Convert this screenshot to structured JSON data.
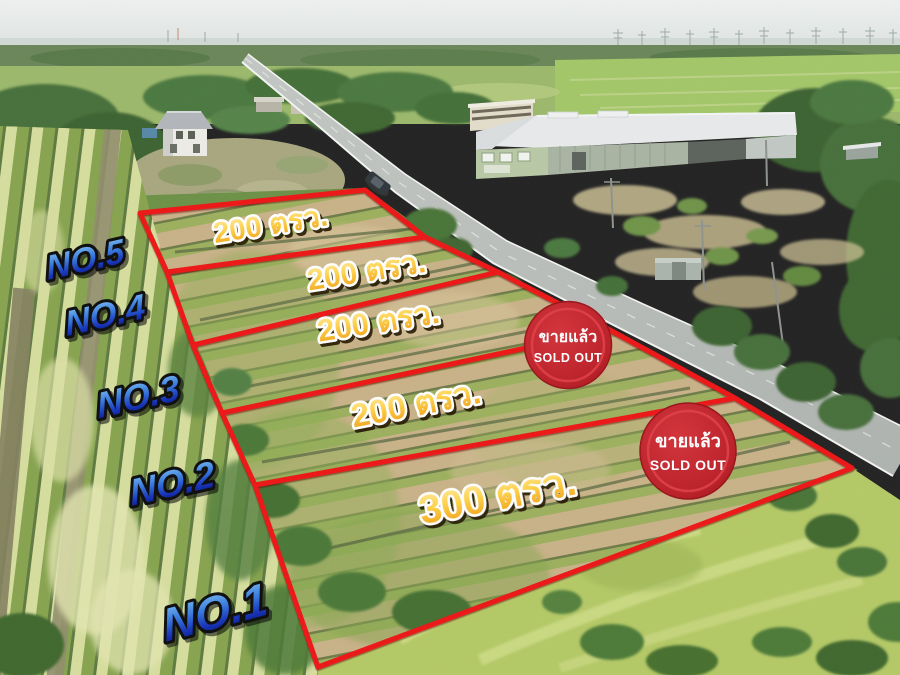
{
  "ad": {
    "kind": "aerial-land-subdivision-sale-photo"
  },
  "plots": [
    {
      "number": "NO.5",
      "size": "200 ตรว."
    },
    {
      "number": "NO.4",
      "size": "200 ตรว."
    },
    {
      "number": "NO.3",
      "size": "200 ตรว."
    },
    {
      "number": "NO.2",
      "size": "200 ตรว."
    },
    {
      "number": "NO.1",
      "size": "300 ตรว."
    }
  ],
  "badges": [
    {
      "thai": "ขายแล้ว",
      "english": "SOLD OUT"
    },
    {
      "thai": "ขายแล้ว",
      "english": "SOLD OUT"
    }
  ],
  "colors": {
    "plot_outline_red": "#ee1418",
    "size_label_gold_top": "#fff0a8",
    "size_label_gold_bottom": "#f09a10",
    "number_label_blue_top": "#8ed0f8",
    "number_label_blue_bottom": "#071663",
    "badge_red": "#bb1f27"
  }
}
